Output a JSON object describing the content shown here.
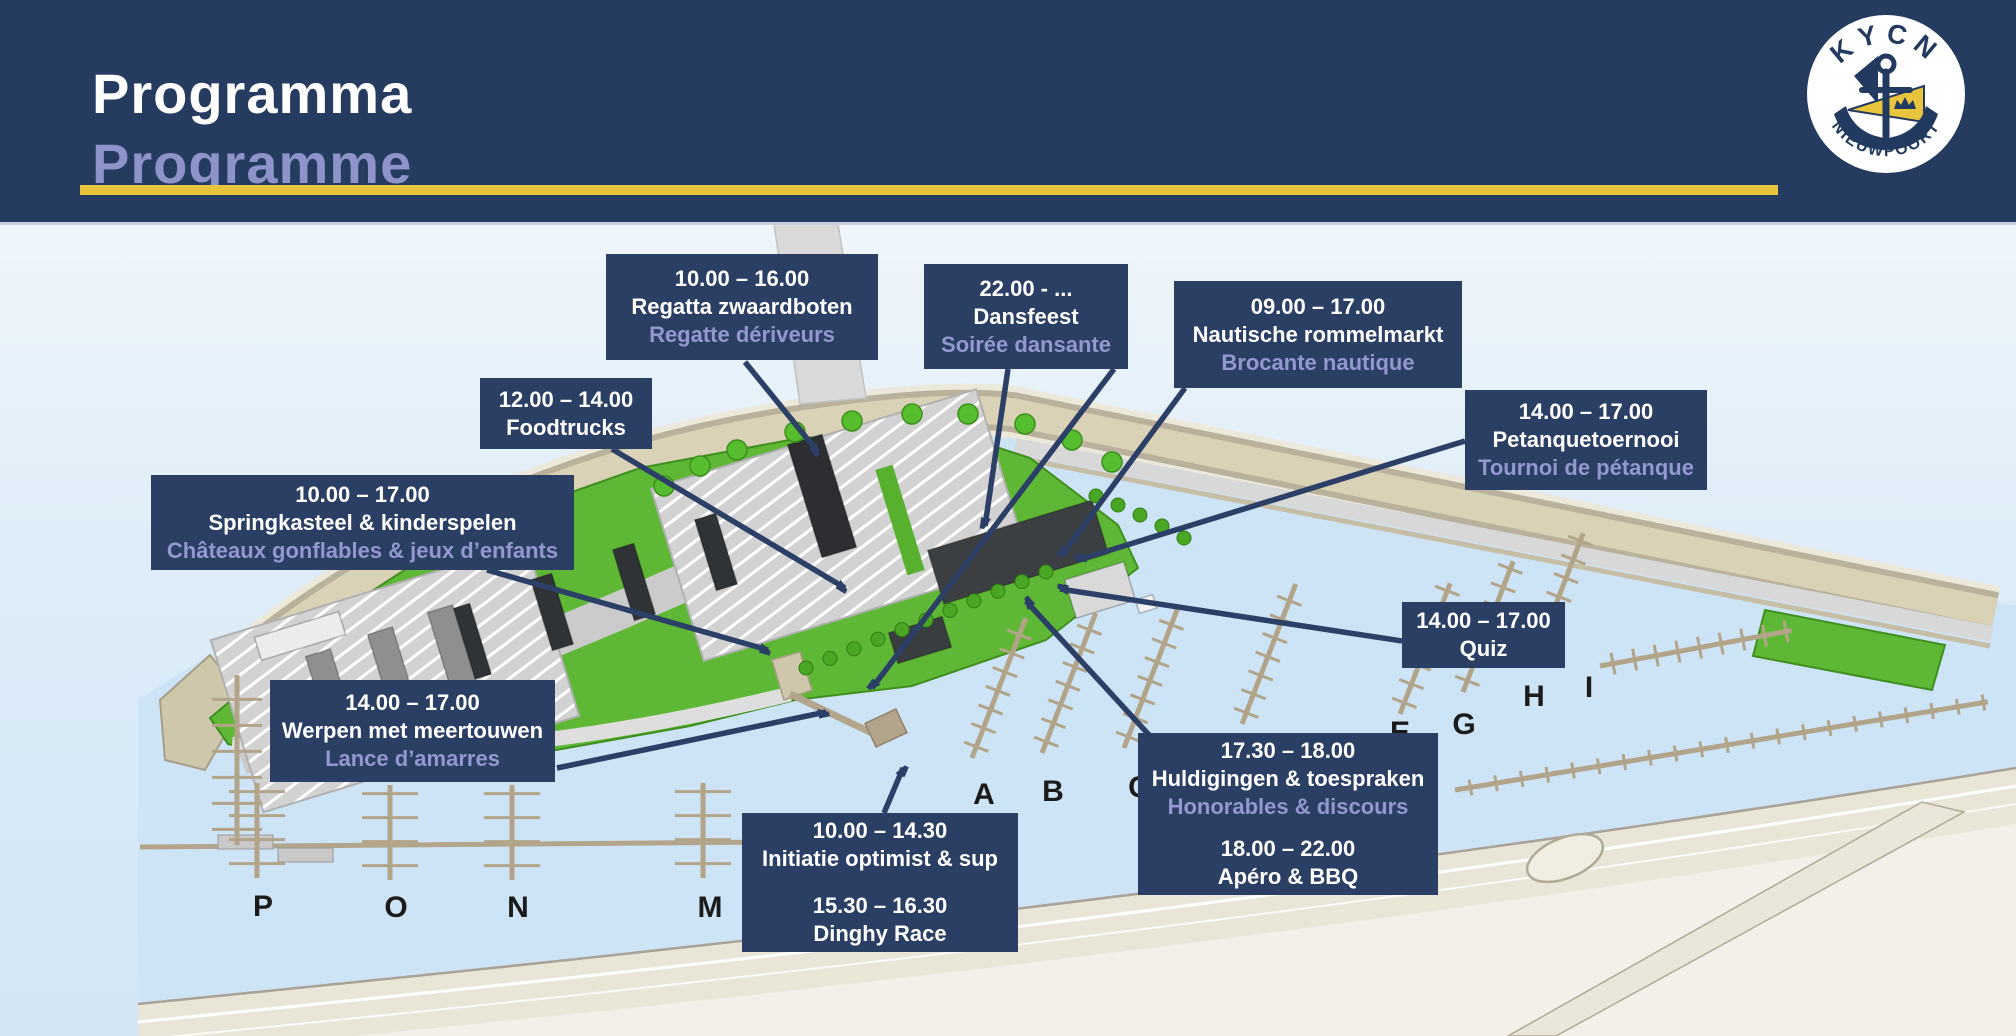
{
  "header": {
    "title_nl": "Programma",
    "title_fr": "Programme",
    "accent_color": "#e9c53e",
    "bg_color": "#263b60",
    "subtitle_color": "#8e93c9"
  },
  "logo": {
    "top_text": "KYCN",
    "bottom_text": "NIEUWPOORT",
    "navy": "#233a60",
    "yellow": "#e9c53e"
  },
  "map": {
    "pier_labels": [
      {
        "label": "A",
        "x": 984,
        "y": 804
      },
      {
        "label": "B",
        "x": 1053,
        "y": 801
      },
      {
        "label": "C",
        "x": 1139,
        "y": 797
      },
      {
        "label": "E",
        "x": 1400,
        "y": 742
      },
      {
        "label": "G",
        "x": 1464,
        "y": 734
      },
      {
        "label": "H",
        "x": 1534,
        "y": 706
      },
      {
        "label": "I",
        "x": 1589,
        "y": 697
      },
      {
        "label": "M",
        "x": 710,
        "y": 917
      },
      {
        "label": "N",
        "x": 518,
        "y": 917
      },
      {
        "label": "O",
        "x": 396,
        "y": 917
      },
      {
        "label": "P",
        "x": 263,
        "y": 916
      }
    ]
  },
  "events": [
    {
      "id": "regatta",
      "box": {
        "left": 606,
        "top": 254,
        "width": 272,
        "height": 106
      },
      "lines": [
        {
          "t": "10.00 – 16.00",
          "c": "w"
        },
        {
          "t": "Regatta zwaardboten",
          "c": "w"
        },
        {
          "t": "Regatte dériveurs",
          "c": "l"
        }
      ],
      "arrows": [
        [
          745,
          362,
          818,
          452
        ]
      ]
    },
    {
      "id": "dansfeest",
      "box": {
        "left": 924,
        "top": 264,
        "width": 204,
        "height": 105
      },
      "lines": [
        {
          "t": "22.00 - ...",
          "c": "w"
        },
        {
          "t": "Dansfeest",
          "c": "w"
        },
        {
          "t": "Soirée dansante",
          "c": "l"
        }
      ],
      "arrows": [
        [
          1008,
          369,
          985,
          526
        ],
        [
          1114,
          369,
          872,
          688
        ]
      ]
    },
    {
      "id": "rommelmarkt",
      "box": {
        "left": 1174,
        "top": 281,
        "width": 288,
        "height": 107
      },
      "lines": [
        {
          "t": "09.00 – 17.00",
          "c": "w"
        },
        {
          "t": "Nautische rommelmarkt",
          "c": "w"
        },
        {
          "t": "Brocante nautique",
          "c": "l"
        }
      ],
      "arrows": [
        [
          1185,
          388,
          1062,
          555
        ]
      ]
    },
    {
      "id": "petanque",
      "box": {
        "left": 1465,
        "top": 390,
        "width": 242,
        "height": 100
      },
      "lines": [
        {
          "t": "14.00 – 17.00",
          "c": "w"
        },
        {
          "t": "Petanquetoernooi",
          "c": "w"
        },
        {
          "t": "Tournoi de pétanque",
          "c": "l"
        }
      ],
      "arrows": [
        [
          1465,
          441,
          1078,
          560
        ]
      ]
    },
    {
      "id": "foodtrucks",
      "box": {
        "left": 480,
        "top": 378,
        "width": 172,
        "height": 71
      },
      "lines": [
        {
          "t": "12.00 – 14.00",
          "c": "w"
        },
        {
          "t": "Foodtrucks",
          "c": "w"
        }
      ],
      "arrows": [
        [
          612,
          449,
          845,
          588
        ]
      ]
    },
    {
      "id": "springkasteel",
      "box": {
        "left": 151,
        "top": 475,
        "width": 423,
        "height": 95
      },
      "lines": [
        {
          "t": "10.00 – 17.00",
          "c": "w"
        },
        {
          "t": "Springkasteel & kinderspelen",
          "c": "w"
        },
        {
          "t": "Châteaux gonflables & jeux d’enfants",
          "c": "l"
        }
      ],
      "arrows": [
        [
          487,
          570,
          768,
          650
        ]
      ]
    },
    {
      "id": "werpen",
      "box": {
        "left": 270,
        "top": 680,
        "width": 285,
        "height": 102
      },
      "lines": [
        {
          "t": "14.00 – 17.00",
          "c": "w"
        },
        {
          "t": "Werpen met meertouwen",
          "c": "w"
        },
        {
          "t": "Lance d’amarres",
          "c": "l"
        }
      ],
      "arrows": [
        [
          557,
          768,
          826,
          712
        ]
      ]
    },
    {
      "id": "quiz",
      "box": {
        "left": 1402,
        "top": 602,
        "width": 163,
        "height": 66
      },
      "lines": [
        {
          "t": "14.00 – 17.00",
          "c": "w"
        },
        {
          "t": "Quiz",
          "c": "w"
        }
      ],
      "arrows": [
        [
          1402,
          641,
          1060,
          589
        ]
      ]
    },
    {
      "id": "huldigingen",
      "box": {
        "left": 1138,
        "top": 733,
        "width": 300,
        "height": 162
      },
      "lines": [
        {
          "t": "17.30 – 18.00",
          "c": "w"
        },
        {
          "t": "Huldigingen & toespraken",
          "c": "w"
        },
        {
          "t": "Honorables & discours",
          "c": "l"
        },
        {
          "t": "",
          "c": "s"
        },
        {
          "t": "18.00 – 22.00",
          "c": "w"
        },
        {
          "t": "Apéro & BBQ",
          "c": "w"
        }
      ],
      "arrows": [
        [
          1150,
          736,
          1026,
          601
        ]
      ]
    },
    {
      "id": "initiatie",
      "box": {
        "left": 742,
        "top": 813,
        "width": 276,
        "height": 139
      },
      "lines": [
        {
          "t": "10.00 – 14.30",
          "c": "w"
        },
        {
          "t": "Initiatie optimist & sup",
          "c": "w"
        },
        {
          "t": "",
          "c": "s"
        },
        {
          "t": "15.30 – 16.30",
          "c": "w"
        },
        {
          "t": "Dinghy Race",
          "c": "w"
        }
      ],
      "arrows": [
        [
          884,
          813,
          903,
          768
        ]
      ]
    }
  ]
}
